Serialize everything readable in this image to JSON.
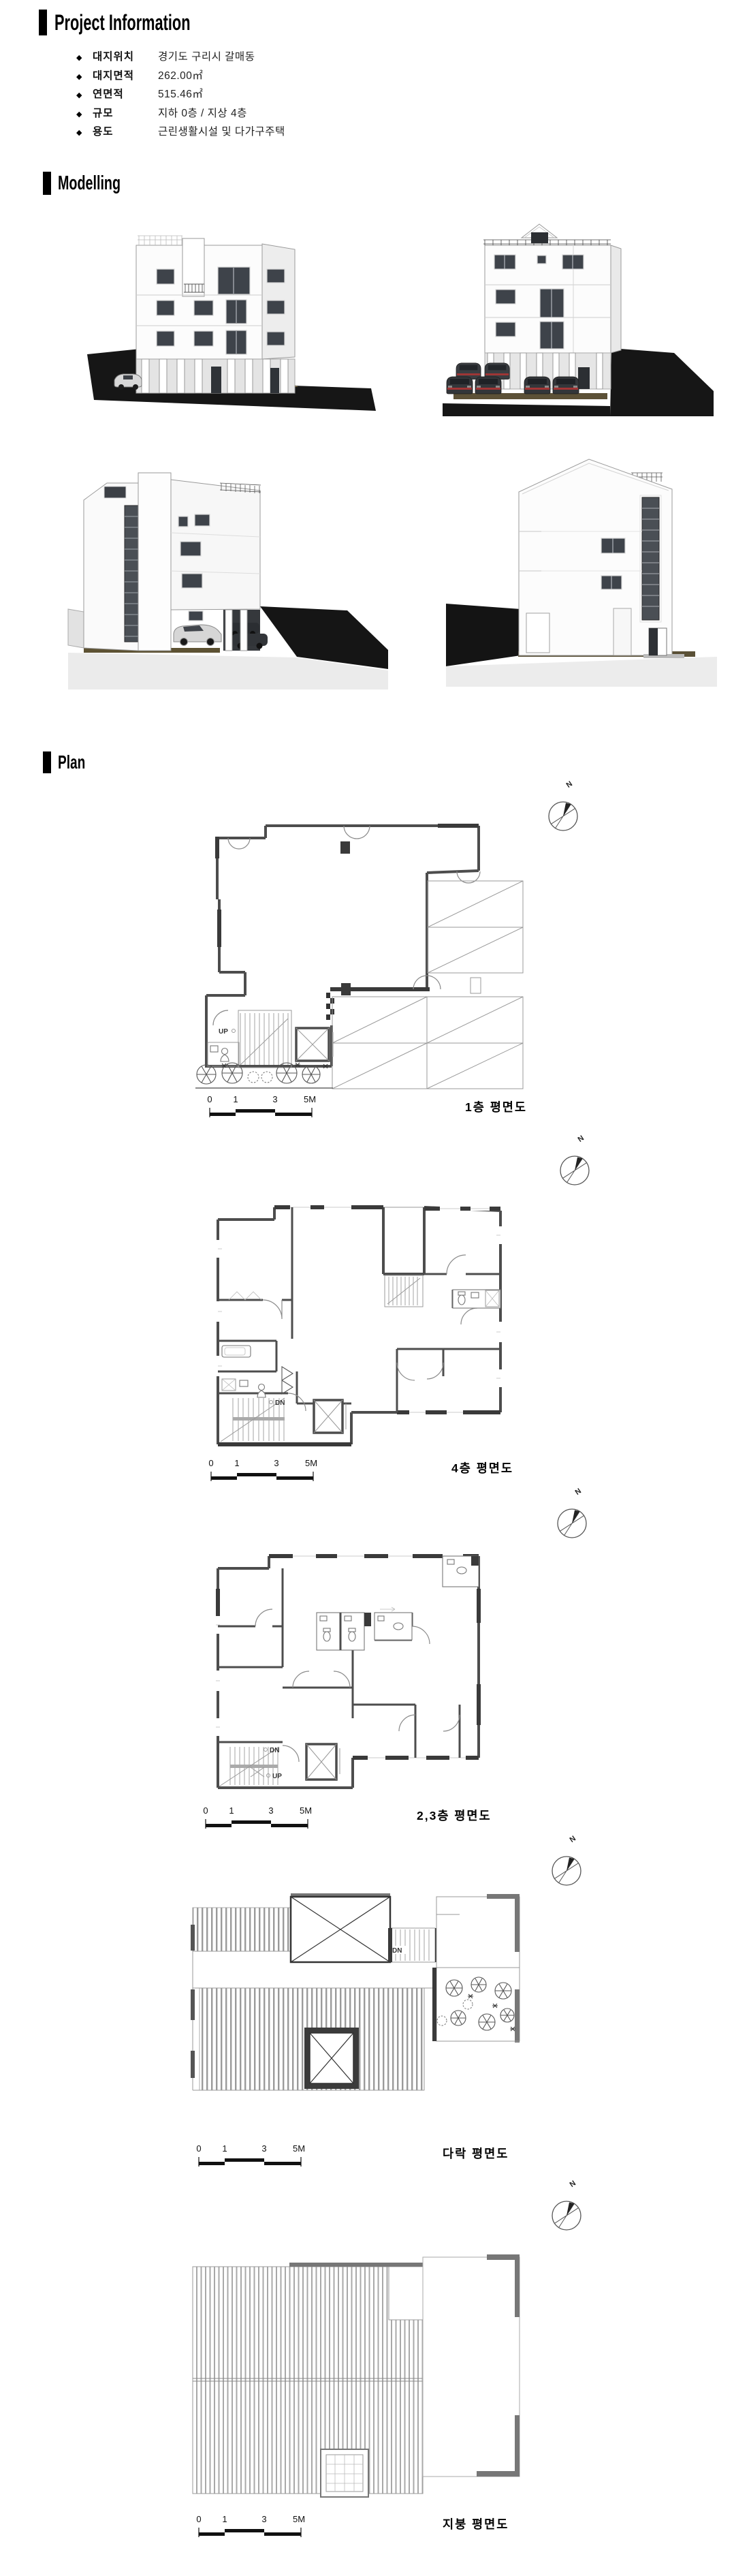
{
  "page": {
    "background": "#ffffff",
    "accent_black": "#000000"
  },
  "project_info": {
    "title": "Project Information",
    "bullet_char": "◆",
    "items": [
      {
        "label": "대지위치",
        "value": "경기도 구리시 갈매동"
      },
      {
        "label": "대지면적",
        "value": "262.00㎡"
      },
      {
        "label": "연면적",
        "value": "515.46㎡"
      },
      {
        "label": "규모",
        "value": "지하 0층 / 지상 4층"
      },
      {
        "label": "용도",
        "value": "근린생활시설 및 다가구주택"
      }
    ]
  },
  "modelling": {
    "title": "Modelling",
    "views": [
      {
        "name": "front elevation render"
      },
      {
        "name": "rear elevation render with parking"
      },
      {
        "name": "side perspective render with parking"
      },
      {
        "name": "gable side elevation render"
      }
    ]
  },
  "plan": {
    "title": "Plan",
    "compass_label": "N",
    "scale_labels": [
      "0",
      "1",
      "3",
      "5M"
    ],
    "stair_labels": {
      "up": "UP",
      "dn": "DN"
    },
    "figures": [
      {
        "caption": "1층 평면도"
      },
      {
        "caption": "4층 평면도"
      },
      {
        "caption": "2,3층 평면도"
      },
      {
        "caption": "다락 평면도"
      },
      {
        "caption": "지붕 평면도"
      }
    ]
  }
}
